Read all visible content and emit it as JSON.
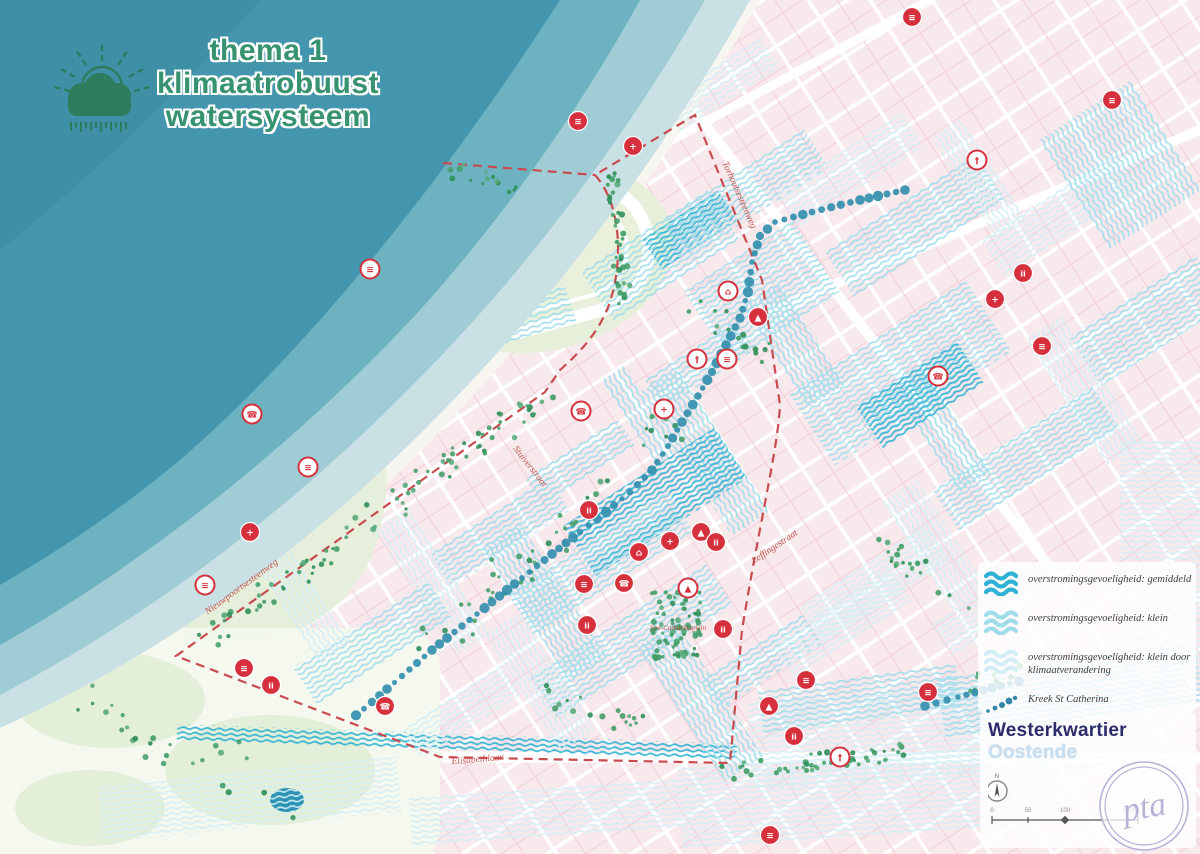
{
  "title": {
    "line1": "thema 1",
    "line2": "klimaatrobuust",
    "line3": "watersysteem"
  },
  "legend": {
    "items": [
      {
        "type": "wave",
        "color": "#2fb2d3",
        "label": "overstromingsgevoeligheid: gemiddeld"
      },
      {
        "type": "wave",
        "color": "#9fdceb",
        "label": "overstromingsgevoeligheid: klein"
      },
      {
        "type": "wave",
        "color": "#d4eef5",
        "label": "overstromingsgevoeligheid: klein door klimaatverandering"
      },
      {
        "type": "dots",
        "color": "#2f86a5",
        "label": "Kreek St Catherina"
      }
    ]
  },
  "footer": {
    "area_name": "Westerkwartier",
    "city_name": "Oostende",
    "north_label": "N",
    "scale_labels": [
      "0",
      "50",
      "100",
      "250m"
    ],
    "logo_text": "pta"
  },
  "colors": {
    "accent_red": "#d6303c",
    "boundary_red": "#c94b4f",
    "flood_medium": "#2fb2d3",
    "flood_small": "#9fdceb",
    "flood_small_cc": "#d4eef5",
    "creek": "#338fae",
    "sea_deep": "#4496af",
    "park_green": "#e5efdb",
    "city_pink": "#f8e9ed",
    "title_green": "#36926f",
    "navy": "#2b2b6b",
    "logo_purple": "#b7b2d8",
    "tree_green": "#3f9d66"
  },
  "map": {
    "street_labels": [
      {
        "text": "Torhoutsesteenweg",
        "x": 737,
        "y": 196,
        "rot": 66,
        "size": 9.5
      },
      {
        "text": "Stuiverstraat",
        "x": 528,
        "y": 468,
        "rot": 52,
        "size": 9.5
      },
      {
        "text": "Leffingestraat",
        "x": 776,
        "y": 549,
        "rot": -34,
        "size": 9.5
      },
      {
        "text": "Nieuwpoortsesteenweg",
        "x": 243,
        "y": 589,
        "rot": -36,
        "size": 9.5
      },
      {
        "text": "Elisabethlaan",
        "x": 478,
        "y": 762,
        "rot": -5,
        "size": 9.5
      },
      {
        "text": "Sint-Catharinaplein",
        "x": 678,
        "y": 630,
        "rot": 0,
        "size": 7
      }
    ],
    "poi_icons": [
      [
        912,
        17,
        "s",
        "≡"
      ],
      [
        1112,
        100,
        "s",
        "≡"
      ],
      [
        578,
        121,
        "s",
        "≡"
      ],
      [
        633,
        146,
        "s",
        "+"
      ],
      [
        977,
        160,
        "o",
        "†"
      ],
      [
        370,
        269,
        "o",
        "≡"
      ],
      [
        252,
        414,
        "o",
        "☎"
      ],
      [
        308,
        467,
        "o",
        "≡"
      ],
      [
        205,
        585,
        "o",
        "≡"
      ],
      [
        728,
        291,
        "o",
        "⌂"
      ],
      [
        758,
        317,
        "s",
        "▲"
      ],
      [
        697,
        359,
        "o",
        "†"
      ],
      [
        727,
        359,
        "o",
        "≡"
      ],
      [
        1023,
        273,
        "s",
        "ii"
      ],
      [
        995,
        299,
        "s",
        "+"
      ],
      [
        1042,
        346,
        "s",
        "≡"
      ],
      [
        938,
        376,
        "o",
        "☎"
      ],
      [
        581,
        411,
        "o",
        "☎"
      ],
      [
        664,
        409,
        "o",
        "+"
      ],
      [
        250,
        532,
        "s",
        "+"
      ],
      [
        589,
        510,
        "s",
        "ii"
      ],
      [
        639,
        552,
        "s",
        "⌂"
      ],
      [
        670,
        541,
        "s",
        "+"
      ],
      [
        701,
        532,
        "s",
        "▲"
      ],
      [
        716,
        542,
        "s",
        "ii"
      ],
      [
        584,
        584,
        "s",
        "≡"
      ],
      [
        624,
        583,
        "s",
        "☎"
      ],
      [
        688,
        588,
        "o",
        "▲"
      ],
      [
        587,
        625,
        "s",
        "ii"
      ],
      [
        723,
        629,
        "s",
        "ii"
      ],
      [
        806,
        680,
        "s",
        "≡"
      ],
      [
        769,
        706,
        "s",
        "▲"
      ],
      [
        794,
        736,
        "s",
        "ii"
      ],
      [
        840,
        757,
        "o",
        "†"
      ],
      [
        928,
        692,
        "s",
        "≡"
      ],
      [
        770,
        835,
        "s",
        "≡"
      ],
      [
        244,
        668,
        "s",
        "≡"
      ],
      [
        271,
        685,
        "s",
        "ii"
      ],
      [
        385,
        706,
        "s",
        "☎"
      ]
    ],
    "creek_segments": [
      [
        [
          905,
          190
        ],
        [
          860,
          200
        ],
        [
          812,
          212
        ],
        [
          775,
          222
        ],
        [
          760,
          236
        ]
      ],
      [
        [
          760,
          236
        ],
        [
          752,
          262
        ],
        [
          748,
          292
        ],
        [
          740,
          318
        ],
        [
          726,
          345
        ],
        [
          712,
          372
        ],
        [
          698,
          396
        ],
        [
          682,
          422
        ],
        [
          668,
          446
        ],
        [
          652,
          470
        ],
        [
          630,
          492
        ],
        [
          606,
          512
        ],
        [
          580,
          532
        ],
        [
          552,
          554
        ],
        [
          522,
          578
        ],
        [
          492,
          602
        ],
        [
          462,
          626
        ],
        [
          432,
          650
        ],
        [
          402,
          676
        ],
        [
          372,
          702
        ],
        [
          348,
          722
        ]
      ],
      [
        [
          925,
          706
        ],
        [
          958,
          697
        ],
        [
          992,
          688
        ],
        [
          1028,
          679
        ]
      ]
    ]
  }
}
